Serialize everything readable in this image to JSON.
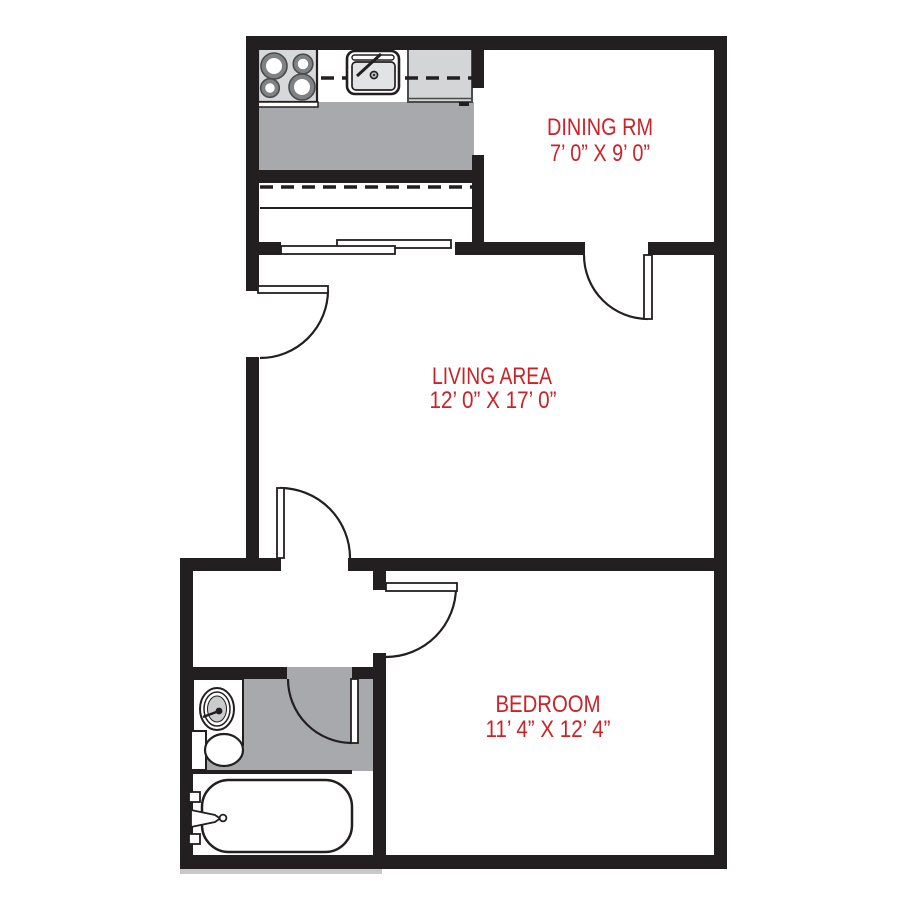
{
  "plan": {
    "type": "apartment-floor-plan",
    "background": "#ffffff"
  },
  "rooms": [
    {
      "id": "dining",
      "name": "DINING RM",
      "dimensions": "7’ 0” X 9’ 0”"
    },
    {
      "id": "living",
      "name": "LIVING AREA",
      "dimensions": "12’ 0” X 17’ 0”"
    },
    {
      "id": "bedroom",
      "name": "BEDROOM",
      "dimensions": "11’ 4” X 12’ 4”"
    }
  ],
  "unlabeled_areas": [
    "kitchen",
    "hallway",
    "bathroom"
  ],
  "fixtures": [
    "stove",
    "kitchen-sink",
    "refrigerator",
    "upper-cabinet-dashed-line",
    "breakfast-bar",
    "sliding-doors",
    "vanity-sink",
    "toilet",
    "bathtub"
  ],
  "doors": [
    "entry-door",
    "hall-door",
    "dining-door",
    "bedroom-door",
    "bathroom-door"
  ],
  "colors": {
    "wall": "#231f20",
    "floor_gray": "#a7a9ac",
    "appliance_gray": "#d7d8d9",
    "label_red": "#cc2127",
    "background": "#ffffff"
  }
}
